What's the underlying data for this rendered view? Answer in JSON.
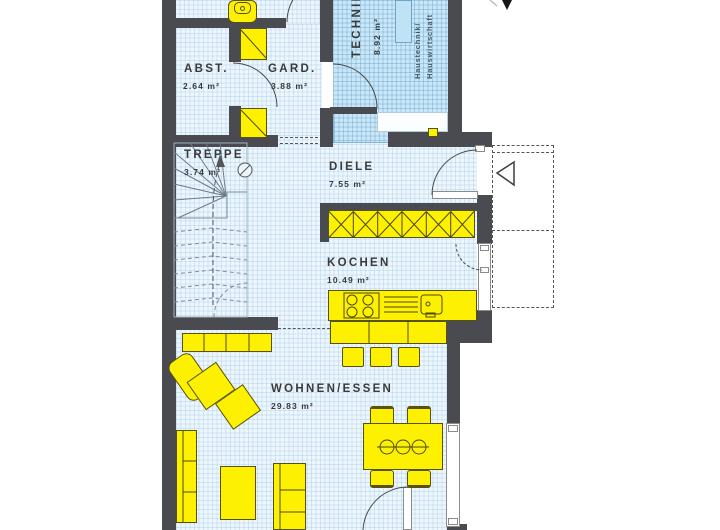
{
  "rooms": {
    "abst": {
      "name": "ABST.",
      "area": "2.64 m²"
    },
    "gard": {
      "name": "GARD.",
      "area": "3.88 m²"
    },
    "technik": {
      "name": "TECHNIK",
      "area": "8.92 m²"
    },
    "treppe": {
      "name": "TREPPE",
      "area": "3.74 m²"
    },
    "diele": {
      "name": "DIELE",
      "area": "7.55 m²"
    },
    "kochen": {
      "name": "KOCHEN",
      "area": "10.49 m²"
    },
    "wohnen_essen": {
      "name": "WOHNEN/ESSEN",
      "area": "29.83 m²"
    }
  },
  "annotations": {
    "technik_note_line1": "Haustechnik/",
    "technik_note_line2": "Hauswirtschaft"
  },
  "icons": {
    "entrance_arrow": "◁",
    "north_arrow": "▼"
  },
  "colors": {
    "wall": "#4a4b50",
    "furniture_yellow": "#fdf000",
    "floor_tint": "#edf6fc",
    "technik_floor": "#c9e7f8",
    "window_glass": "#bfe2f4",
    "line_dark": "#555555"
  }
}
